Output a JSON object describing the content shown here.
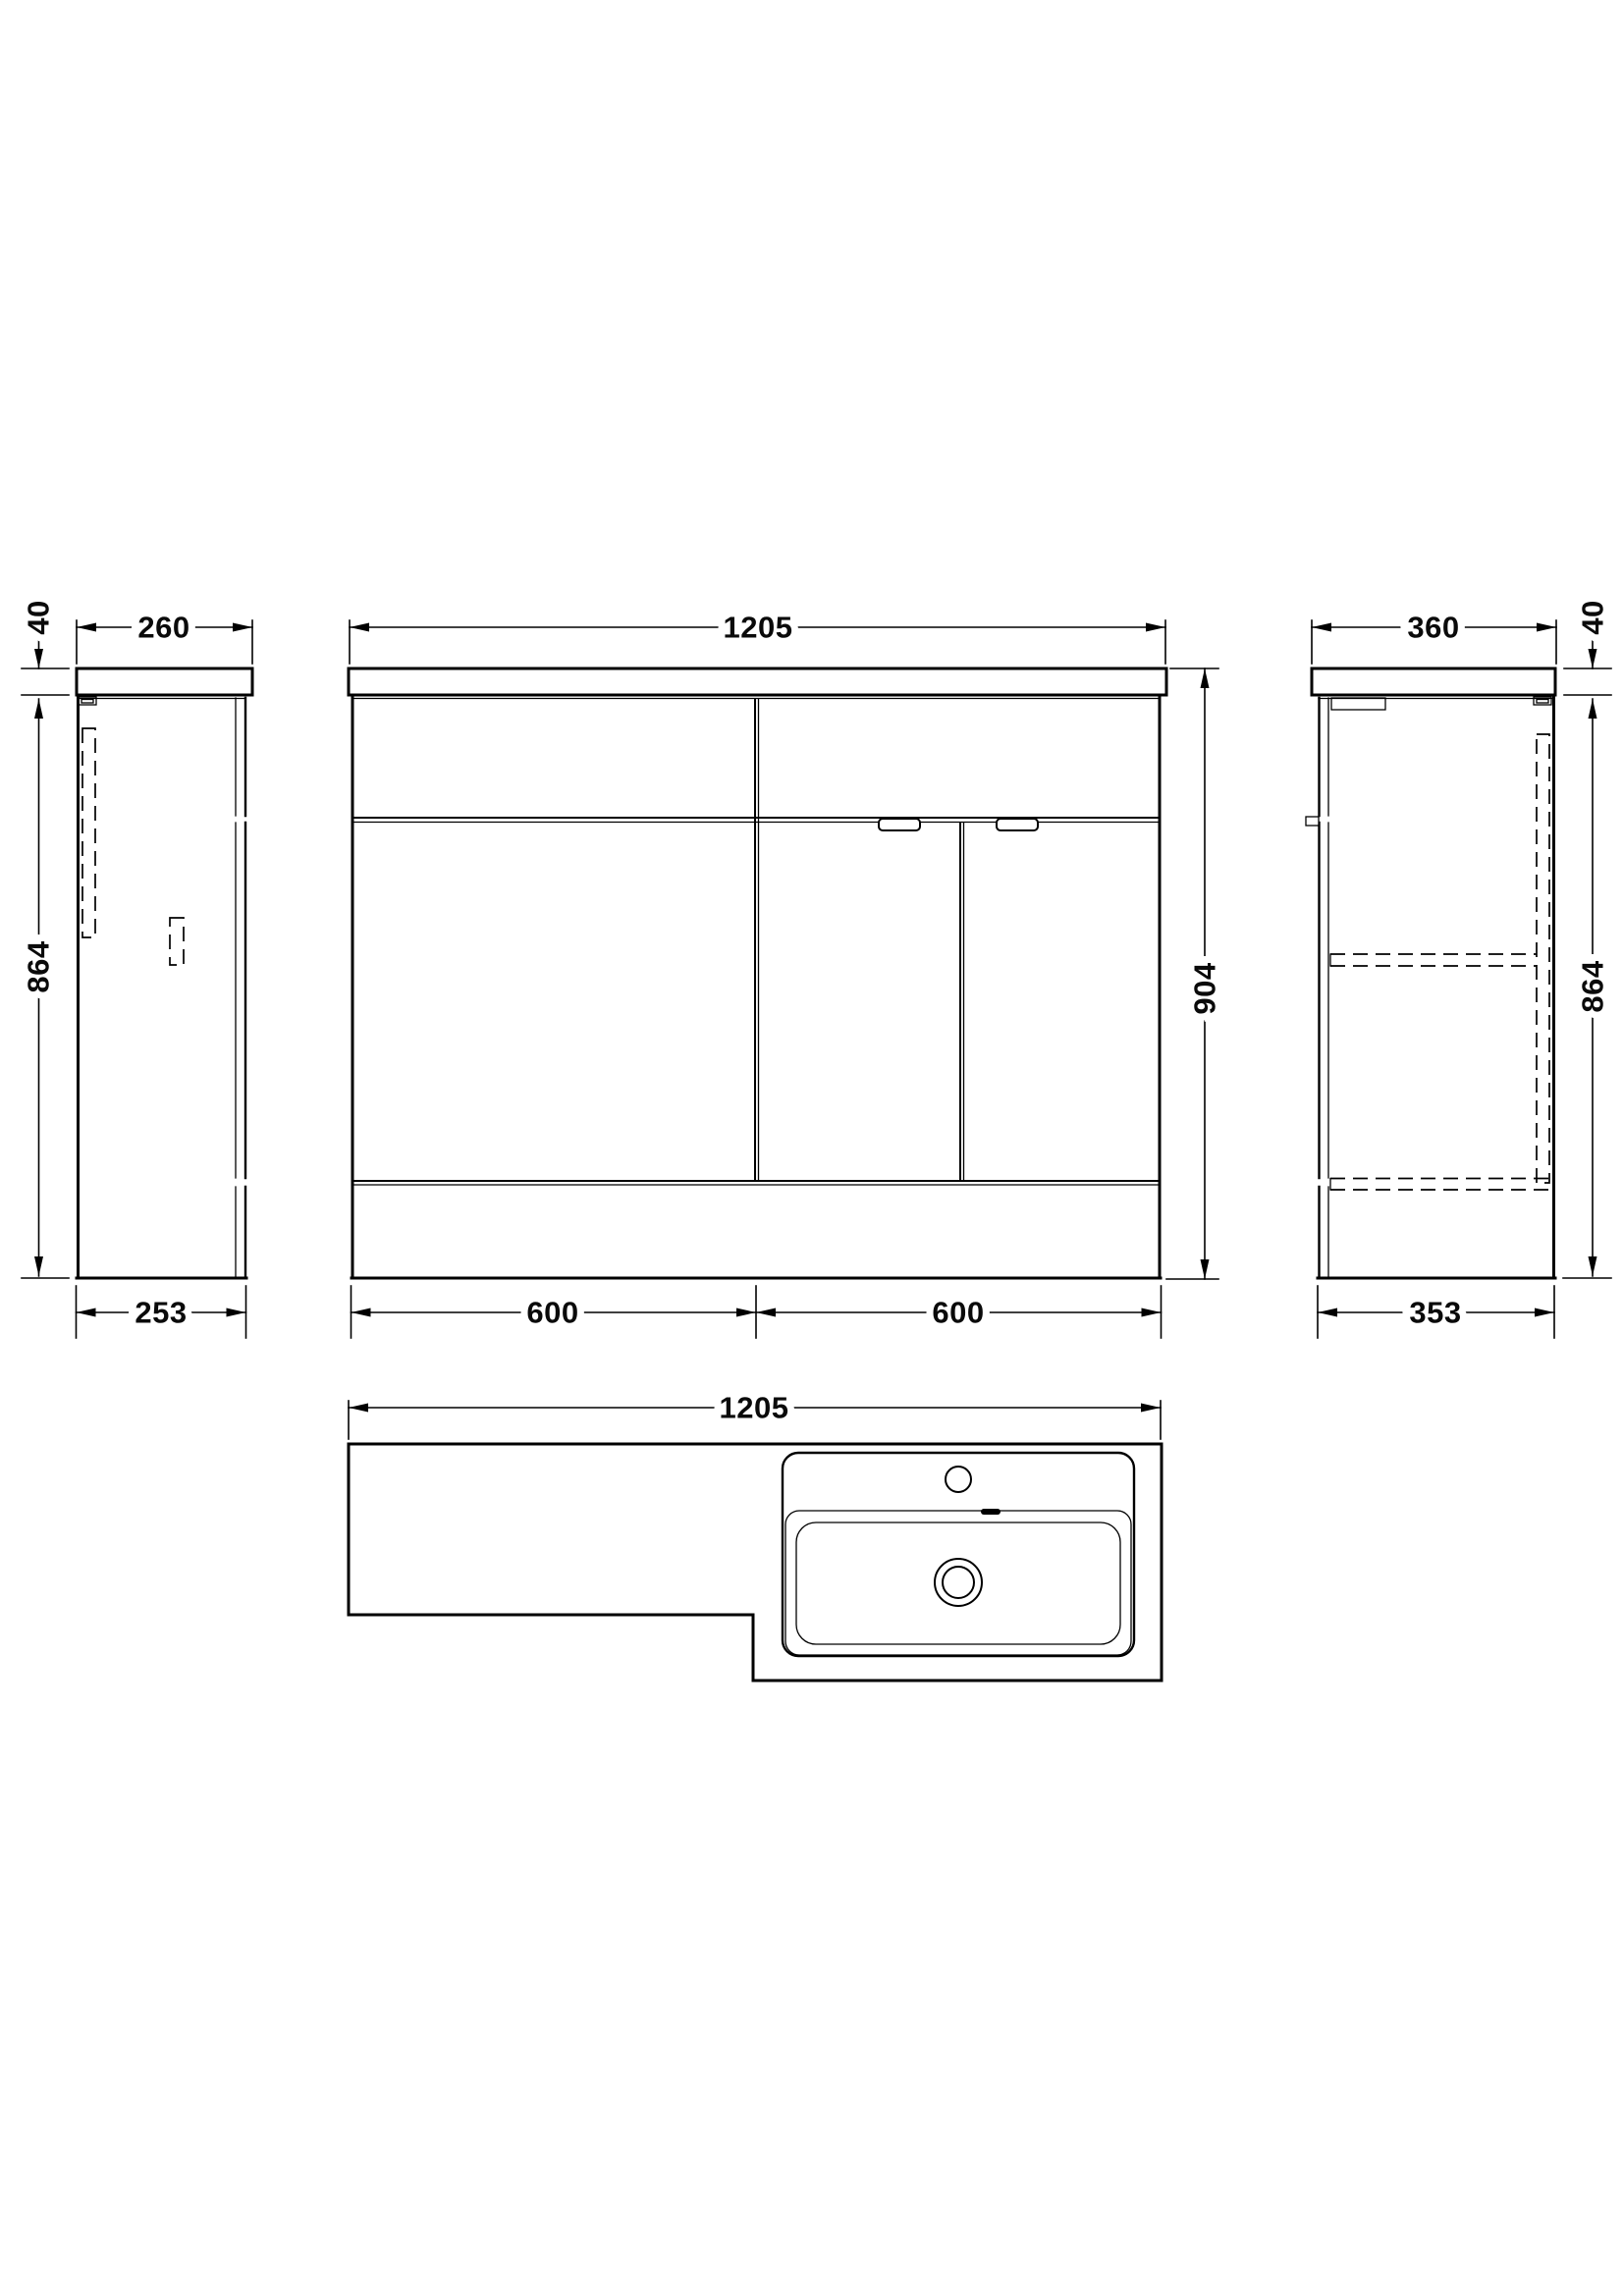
{
  "drawing_type": "bathroom-vanity-unit-technical-drawing",
  "colors": {
    "line": "#000000",
    "background": "#ffffff"
  },
  "dims": {
    "left_view": {
      "width_top": "260",
      "countertop_thickness": "40",
      "height": "864",
      "depth_bottom": "253"
    },
    "front_view": {
      "width": "1205",
      "total_height": "904",
      "left_section": "600",
      "right_section": "600"
    },
    "right_view": {
      "width_top": "360",
      "countertop_thickness": "40",
      "height": "864",
      "depth_bottom": "353"
    },
    "plan_view": {
      "width": "1205"
    }
  }
}
